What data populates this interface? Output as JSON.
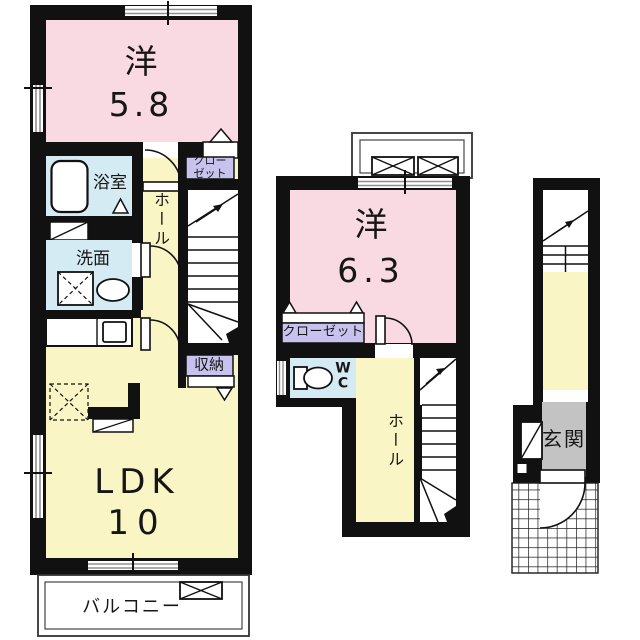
{
  "colors": {
    "wall": "#111111",
    "room_pink": "#F9D9E2",
    "room_yellow": "#FAF5C5",
    "room_blue": "#D5EBF4",
    "label_purple": "#C7C3EE",
    "entrance_gray": "#C3C3C3"
  },
  "plans": {
    "left": {
      "bedroom": {
        "kanji": "洋",
        "size": "5.8"
      },
      "bathroom_label": "浴室",
      "washroom_label": "洗面",
      "hall_label": "ホール",
      "closet_label": "クロー\nゼット",
      "storage_label": "収納",
      "ldk": {
        "kanji": "LDK",
        "size": "10"
      },
      "balcony_label": "バルコニー"
    },
    "middle": {
      "bedroom": {
        "kanji": "洋",
        "size": "6.3"
      },
      "closet_label": "クローゼット",
      "wc_label": "W\nC",
      "hall_label": "ホール"
    },
    "right": {
      "entrance_label": "玄関"
    }
  }
}
